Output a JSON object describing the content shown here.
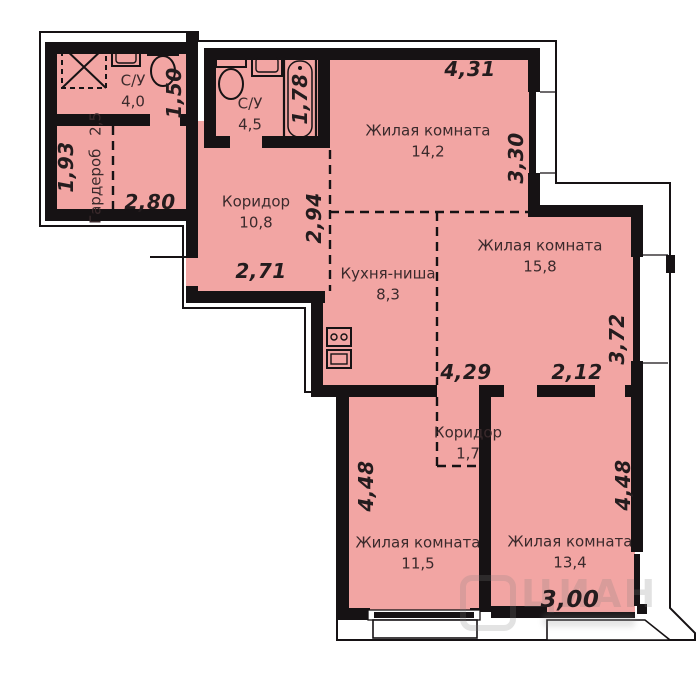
{
  "plan": {
    "colors": {
      "room_fill": "#F2A5A3",
      "wall": "#161214",
      "room_label": "#3B2A2C",
      "dimension_text": "#241C1E",
      "background": "#FFFFFF",
      "watermark": "#7E7E7E"
    },
    "rooms": [
      {
        "name": "С/У",
        "area": "4,0"
      },
      {
        "name": "С/У",
        "area": "4,5"
      },
      {
        "name": "Гардероб",
        "area": "2,5"
      },
      {
        "name": "Коридор",
        "area": "10,8"
      },
      {
        "name": "Жилая комната",
        "area": "14,2"
      },
      {
        "name": "Кухня-ниша",
        "area": "8,3"
      },
      {
        "name": "Жилая комната",
        "area": "15,8"
      },
      {
        "name": "Коридор",
        "area": "1,7"
      },
      {
        "name": "Жилая комната",
        "area": "11,5"
      },
      {
        "name": "Жилая комната",
        "area": "13,4"
      }
    ],
    "dimensions": [
      {
        "value": "4,31"
      },
      {
        "value": "1,50"
      },
      {
        "value": "1,78"
      },
      {
        "value": "3,30"
      },
      {
        "value": "1,93"
      },
      {
        "value": "2,80"
      },
      {
        "value": "2,94"
      },
      {
        "value": "2,71"
      },
      {
        "value": "4,29"
      },
      {
        "value": "2,12"
      },
      {
        "value": "3,72"
      },
      {
        "value": "4,48"
      },
      {
        "value": "4,48"
      },
      {
        "value": "3,00"
      }
    ],
    "watermark": {
      "text": "ЦИАН"
    }
  }
}
